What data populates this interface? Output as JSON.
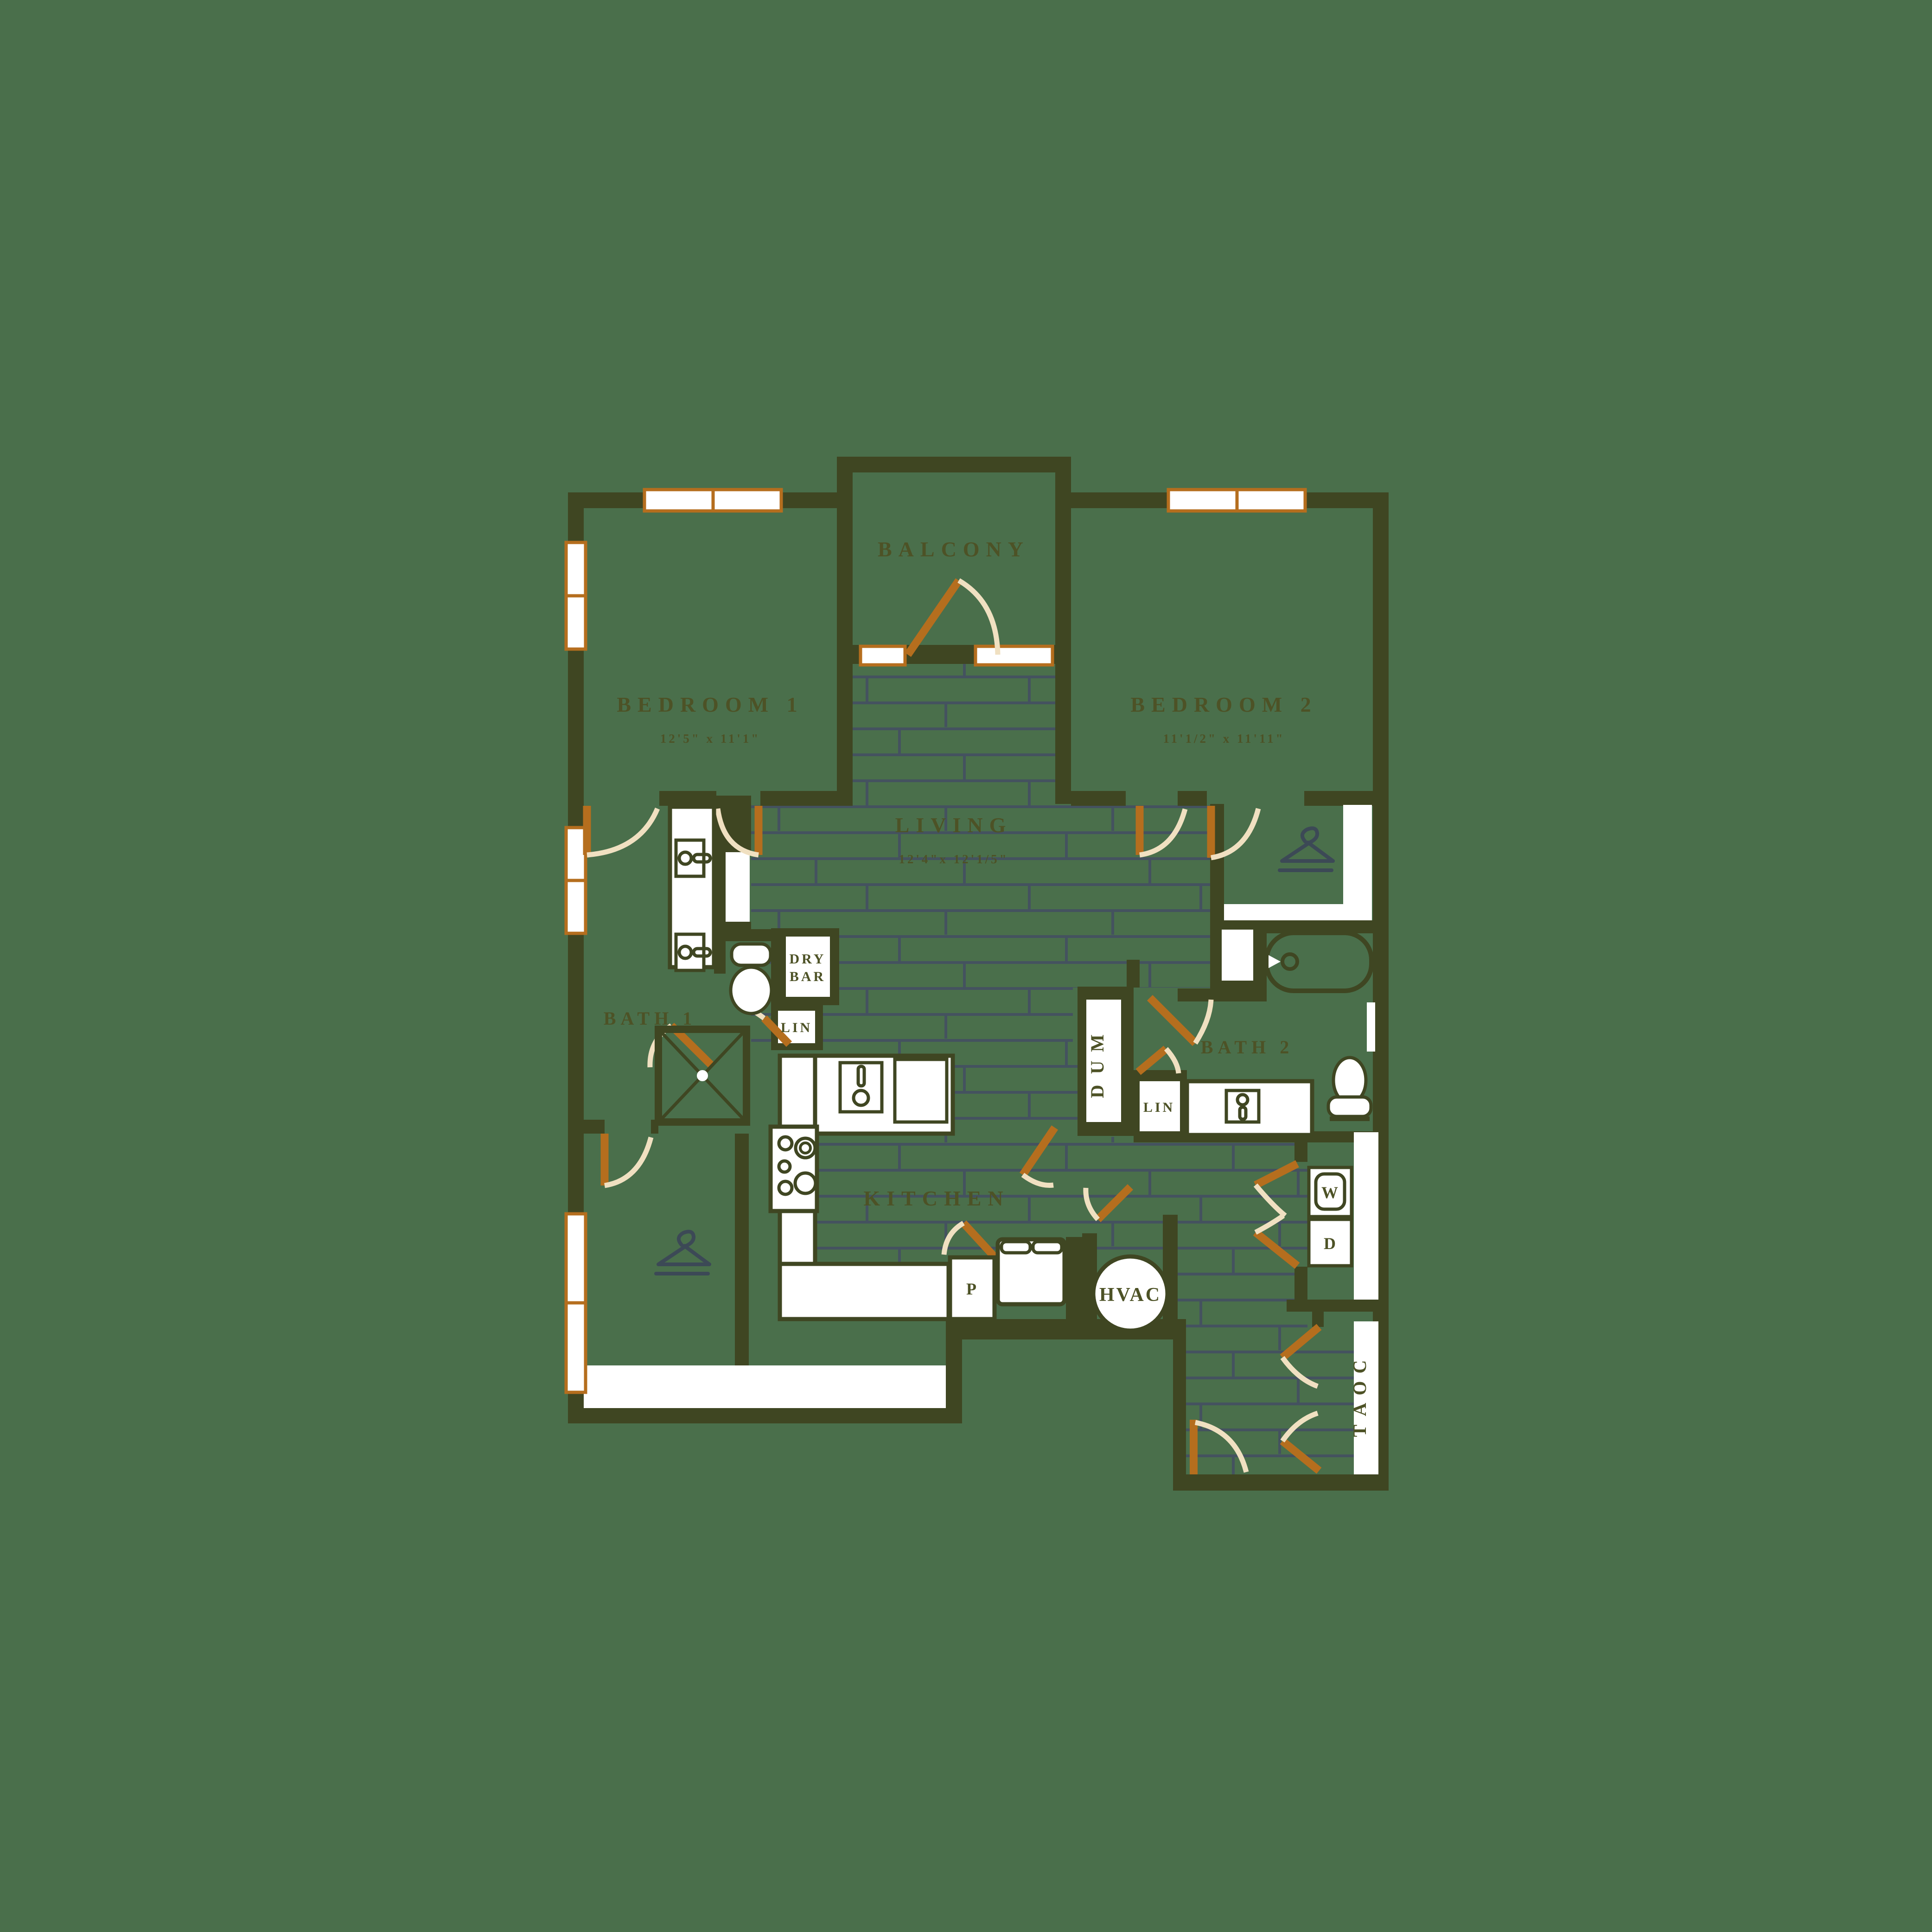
{
  "colors": {
    "background": "#4a6f4b",
    "wall": "#3f4622",
    "floor_line": "#44525f",
    "accent_orange": "#b56e1e",
    "door_arc": "#f0e0c1",
    "fixture": "#ffffff",
    "label": "#4d5226",
    "icon_slate": "#3c4956"
  },
  "rooms": {
    "balcony": {
      "label": "BALCONY"
    },
    "bedroom1": {
      "label": "BEDROOM 1",
      "dims": "12'5\" x 11'1\""
    },
    "bedroom2": {
      "label": "BEDROOM 2",
      "dims": "11'1/2\" x 11'11\""
    },
    "living": {
      "label": "LIVING",
      "dims": "12'4\"x 12'1/5\""
    },
    "kitchen": {
      "label": "KITCHEN"
    },
    "bath1": {
      "label": "BATH 1"
    },
    "bath2": {
      "label": "BATH 2"
    },
    "dry_bar": {
      "line1": "DRY",
      "line2": "BAR"
    },
    "linen1": {
      "label": "LIN"
    },
    "linen2": {
      "label": "LIN"
    },
    "mud": {
      "label": "MUD"
    },
    "pantry": {
      "label": "P"
    },
    "hvac": {
      "label": "HVAC"
    },
    "washer": {
      "label": "W"
    },
    "dryer": {
      "label": "D"
    },
    "coat": {
      "label": "COAT"
    }
  }
}
